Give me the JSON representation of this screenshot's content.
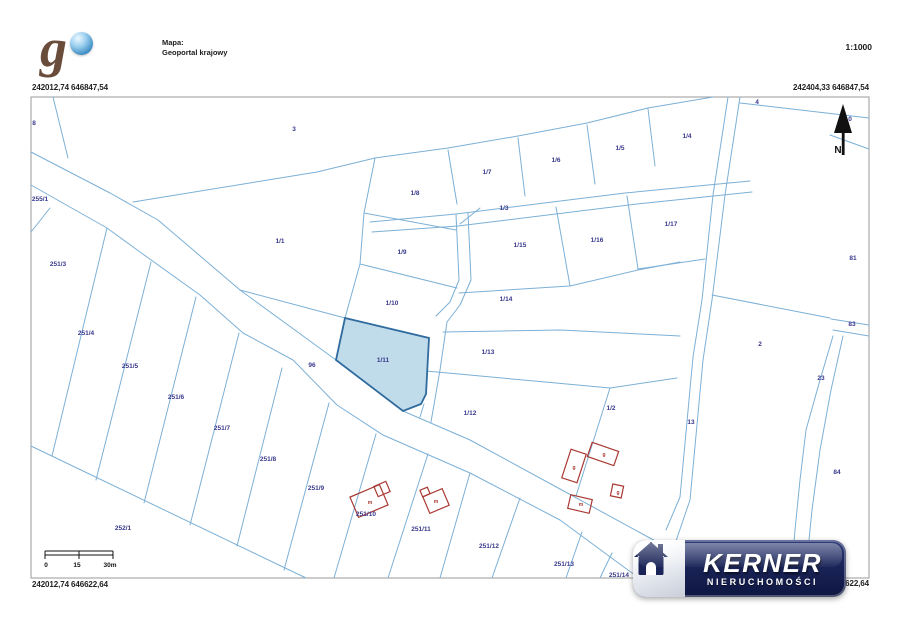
{
  "header": {
    "map_source_label": "Mapa:",
    "map_source_name": "Geoportal krajowy",
    "scale_ratio": "1:1000",
    "logo_letter": "g"
  },
  "coordinates": {
    "top_left": "242012,74 646847,54",
    "top_right": "242404,33 646847,54",
    "bottom_left": "242012,74 646622,64",
    "bottom_right_visible": "622,64"
  },
  "north_label": "N",
  "scale_bar": {
    "labels_positioned": [
      {
        "t": "0",
        "x": 46,
        "y": 567
      },
      {
        "t": "15",
        "x": 77,
        "y": 567
      },
      {
        "t": "30m",
        "x": 110,
        "y": 567
      }
    ]
  },
  "watermark": {
    "brand": "KERNER",
    "subtitle": "NIERUCHOMOŚCI"
  },
  "colors": {
    "parcel_line": "#7cb0d6",
    "parcel_label": "#38388c",
    "highlight_fill": "#b9d8e9",
    "highlight_stroke": "#2f6b9e",
    "building": "#a93832",
    "brand_navy": "#1a2458"
  },
  "map": {
    "highlighted_parcel": "1/11",
    "parcel_labels": [
      {
        "t": "8",
        "x": 34,
        "y": 125
      },
      {
        "t": "3",
        "x": 294,
        "y": 131
      },
      {
        "t": "4",
        "x": 757,
        "y": 104
      },
      {
        "t": "0",
        "x": 850,
        "y": 121
      },
      {
        "t": "255/1",
        "x": 40,
        "y": 201
      },
      {
        "t": "1/1",
        "x": 280,
        "y": 243
      },
      {
        "t": "1/8",
        "x": 415,
        "y": 195
      },
      {
        "t": "1/7",
        "x": 487,
        "y": 174
      },
      {
        "t": "1/6",
        "x": 556,
        "y": 162
      },
      {
        "t": "1/5",
        "x": 620,
        "y": 150
      },
      {
        "t": "1/4",
        "x": 687,
        "y": 138
      },
      {
        "t": "1/3",
        "x": 504,
        "y": 210
      },
      {
        "t": "1/9",
        "x": 402,
        "y": 254
      },
      {
        "t": "1/10",
        "x": 392,
        "y": 305
      },
      {
        "t": "1/15",
        "x": 520,
        "y": 247
      },
      {
        "t": "1/16",
        "x": 597,
        "y": 242
      },
      {
        "t": "1/17",
        "x": 671,
        "y": 226
      },
      {
        "t": "1/14",
        "x": 506,
        "y": 301
      },
      {
        "t": "1/13",
        "x": 488,
        "y": 354
      },
      {
        "t": "1/11",
        "x": 383,
        "y": 362
      },
      {
        "t": "1/12",
        "x": 470,
        "y": 415
      },
      {
        "t": "1/2",
        "x": 611,
        "y": 410
      },
      {
        "t": "2",
        "x": 760,
        "y": 346
      },
      {
        "t": "13",
        "x": 691,
        "y": 424
      },
      {
        "t": "81",
        "x": 853,
        "y": 260
      },
      {
        "t": "83",
        "x": 852,
        "y": 326
      },
      {
        "t": "23",
        "x": 821,
        "y": 380
      },
      {
        "t": "84",
        "x": 837,
        "y": 474
      },
      {
        "t": "96",
        "x": 312,
        "y": 367
      },
      {
        "t": "251/3",
        "x": 58,
        "y": 266
      },
      {
        "t": "251/4",
        "x": 86,
        "y": 335
      },
      {
        "t": "251/5",
        "x": 130,
        "y": 368
      },
      {
        "t": "251/6",
        "x": 176,
        "y": 399
      },
      {
        "t": "251/7",
        "x": 222,
        "y": 430
      },
      {
        "t": "251/8",
        "x": 268,
        "y": 461
      },
      {
        "t": "251/9",
        "x": 316,
        "y": 490
      },
      {
        "t": "252/1",
        "x": 123,
        "y": 530
      },
      {
        "t": "251/10",
        "x": 366,
        "y": 516
      },
      {
        "t": "251/11",
        "x": 421,
        "y": 531
      },
      {
        "t": "251/12",
        "x": 489,
        "y": 548
      },
      {
        "t": "251/13",
        "x": 564,
        "y": 566
      },
      {
        "t": "251/14",
        "x": 619,
        "y": 577
      }
    ],
    "building_labels": [
      {
        "t": "m",
        "x": 370,
        "y": 504
      },
      {
        "t": "m",
        "x": 436,
        "y": 503
      },
      {
        "t": "g",
        "x": 574,
        "y": 469
      },
      {
        "t": "g",
        "x": 604,
        "y": 456
      },
      {
        "t": "g",
        "x": 618,
        "y": 494
      },
      {
        "t": "m",
        "x": 581,
        "y": 506
      }
    ]
  }
}
